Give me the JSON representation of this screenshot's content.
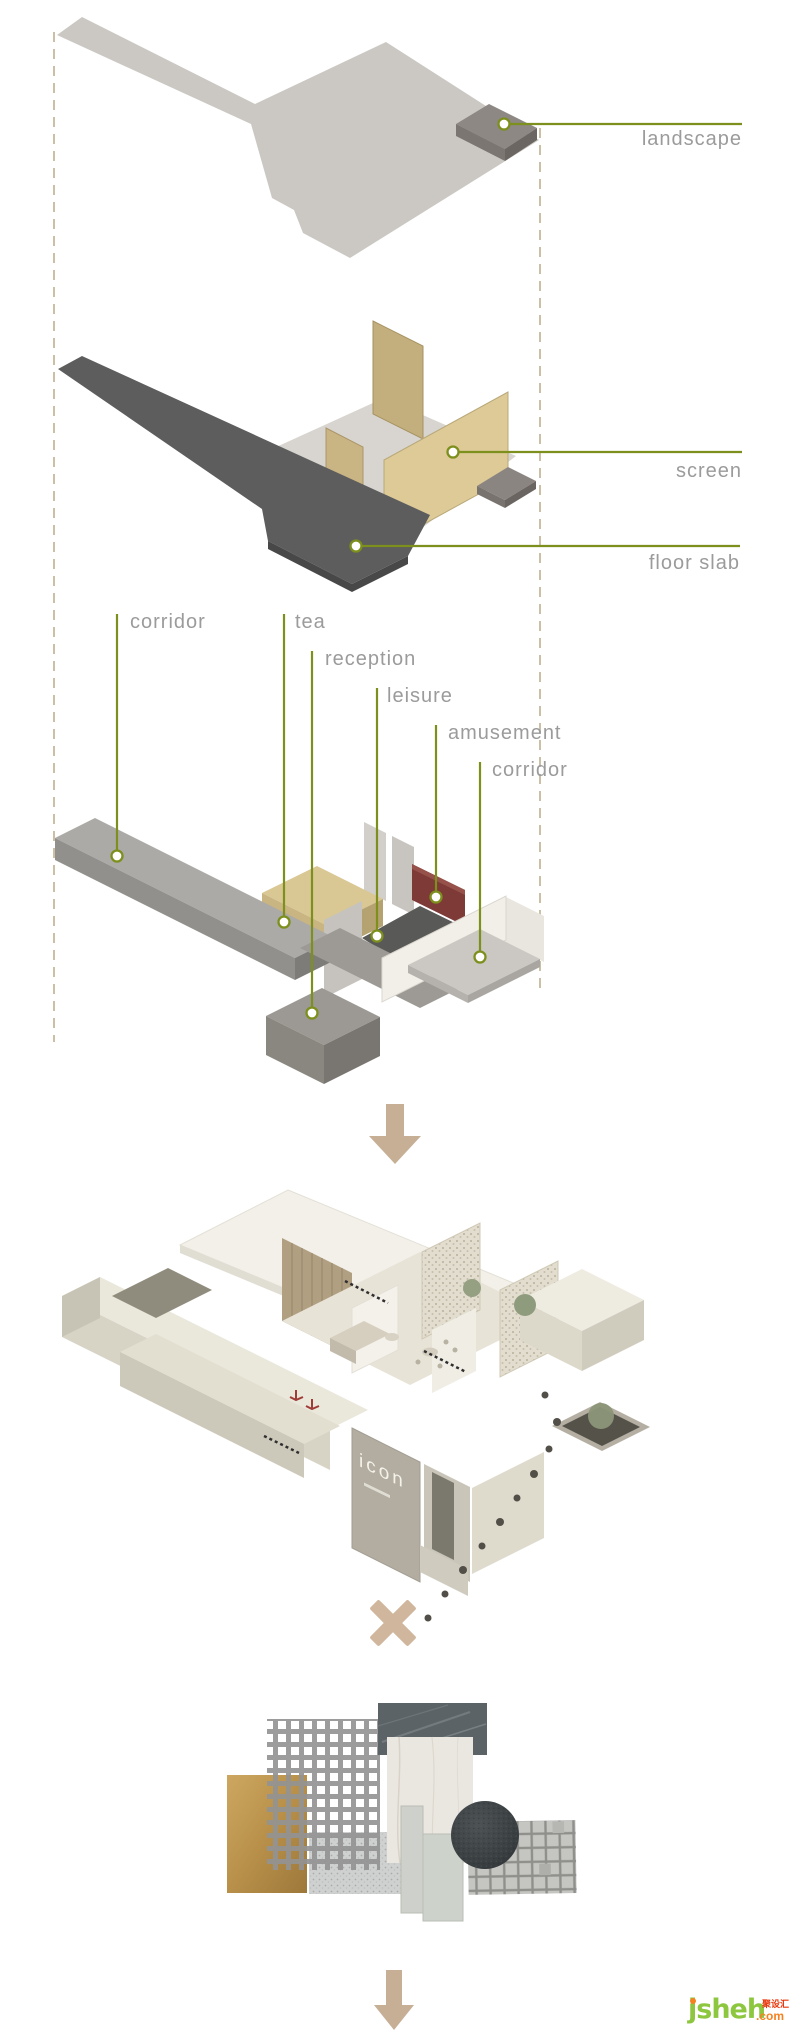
{
  "page": {
    "background": "#ffffff",
    "width": 790,
    "height": 2030
  },
  "exploded_diagram": {
    "callouts": {
      "landscape": "landscape",
      "screen": "screen",
      "floor_slab": "floor slab",
      "corridor_top": "corridor",
      "tea": "tea",
      "reception": "reception",
      "leisure": "leisure",
      "amusement": "amusement",
      "corridor_right": "corridor"
    },
    "colors": {
      "leader_green": "#7d8f1c",
      "label_gray": "#9b9b9b",
      "guide_dash_tan": "#cbbfa6",
      "floor_slab_charcoal": "#5d5d5d",
      "screen_panel_tan": "#ddca97",
      "tea_volume_tan": "#d9c794",
      "amusement_red": "#7d3a37",
      "landscape_plane_gray": "#cbc8c4"
    }
  },
  "axon_model": {
    "sign_text": "icon"
  },
  "connectors": {
    "arrow_color": "#c6af95",
    "cross_color": "#cfb69c"
  },
  "materials_board": {
    "swatches": [
      {
        "name": "gold-metal-sheet",
        "color": "#b8904a"
      },
      {
        "name": "perforated-metal-mesh",
        "color": "#939393"
      },
      {
        "name": "dark-slate-stone",
        "color": "#5c6367"
      },
      {
        "name": "white-marble-slab",
        "color": "#eae7e1"
      },
      {
        "name": "galvanized-steel-sheet",
        "color": "#cfd1d0"
      },
      {
        "name": "concrete-plank-narrow",
        "color": "#ced1cb"
      },
      {
        "name": "concrete-plank-wide",
        "color": "#cdd2ca"
      },
      {
        "name": "dark-carpet-disc",
        "color": "#3d4245"
      },
      {
        "name": "stone-mosaic-tiles",
        "color": "#c5c6c2"
      }
    ]
  },
  "watermark": {
    "brand": "jsheh",
    "tld": ".com",
    "cn_label": "聚设汇",
    "brand_green": "#8dc63f",
    "accent_orange": "#f58220",
    "cn_red": "#e8380d"
  }
}
